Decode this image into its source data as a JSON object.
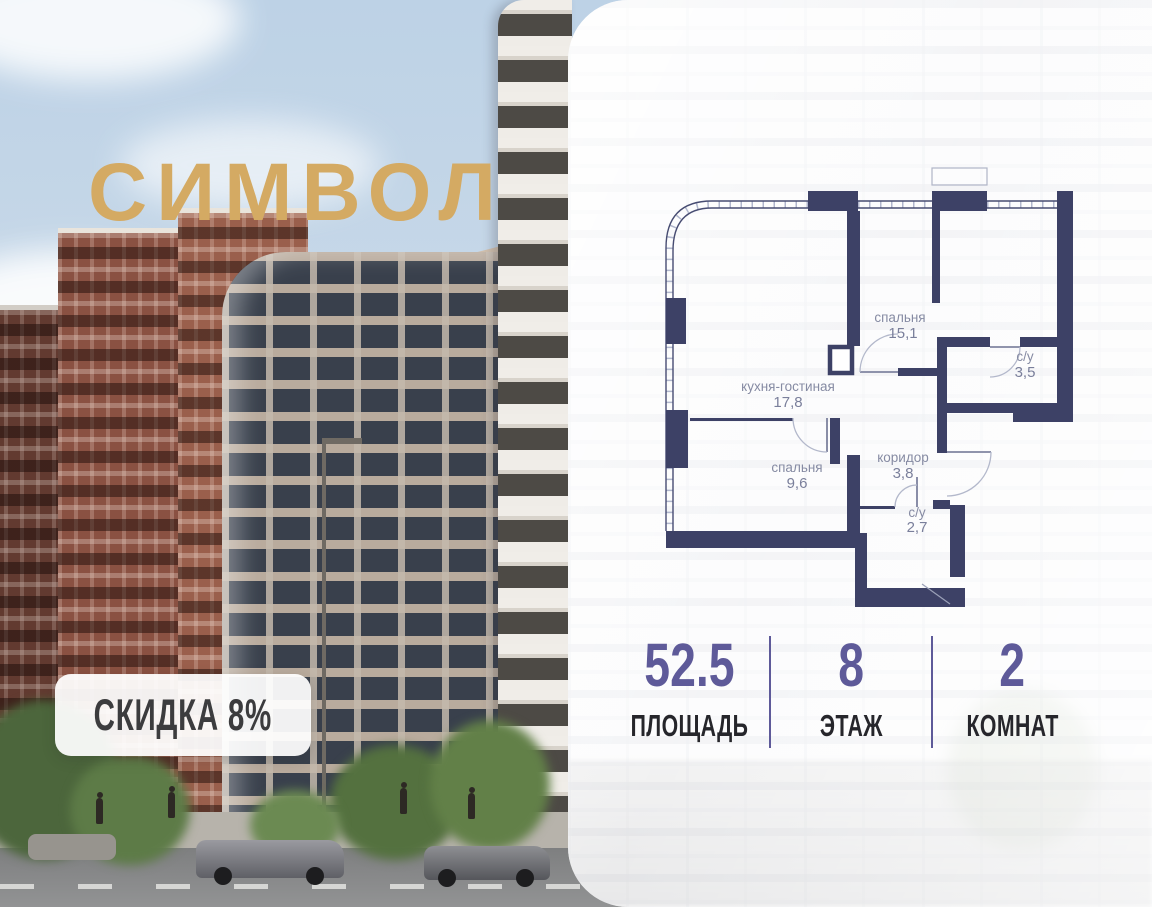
{
  "brand": {
    "logo_text": "СИМВОЛ",
    "logo_color": "#d4aa63"
  },
  "photo": {
    "discount_badge": "СКИДКА 8%"
  },
  "floor_plan": {
    "wall_color": "#3d4166",
    "label_color": "#868ba3",
    "rooms": [
      {
        "name": "спальня",
        "area": "15,1"
      },
      {
        "name": "с/у",
        "area": "3,5"
      },
      {
        "name": "кухня-гостиная",
        "area": "17,8"
      },
      {
        "name": "спальня",
        "area": "9,6"
      },
      {
        "name": "коридор",
        "area": "3,8"
      },
      {
        "name": "с/у",
        "area": "2,7"
      }
    ]
  },
  "stats": {
    "accent_color": "#5e5a99",
    "items": [
      {
        "value": "52.5",
        "label": "ПЛОЩАДЬ"
      },
      {
        "value": "8",
        "label": "ЭТАЖ"
      },
      {
        "value": "2",
        "label": "КОМНАТ"
      }
    ]
  }
}
